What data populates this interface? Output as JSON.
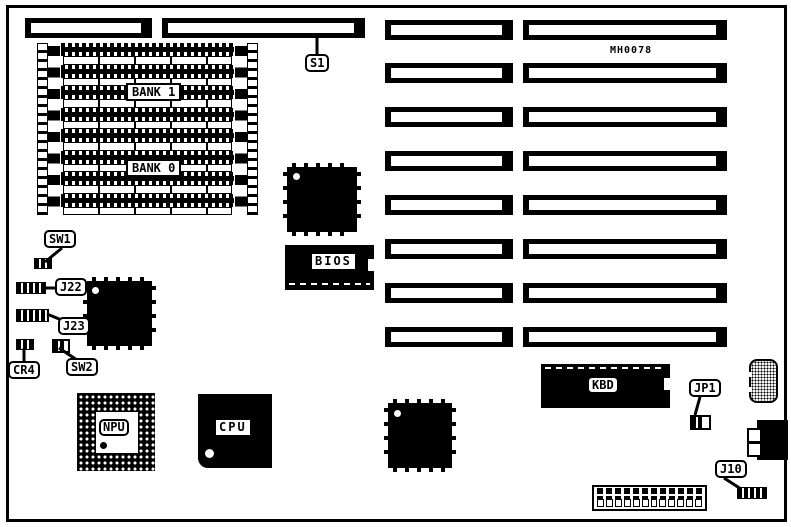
{
  "figure": {
    "part_number": "MH0078"
  },
  "labels": {
    "s1": "S1",
    "bank1": "BANK 1",
    "bank0": "BANK 0",
    "sw1": "SW1",
    "j22": "J22",
    "j23": "J23",
    "cr4": "CR4",
    "sw2": "SW2",
    "bios": "BIOS",
    "npu": "NPU",
    "cpu": "CPU",
    "kbd": "KBD",
    "jp1": "JP1",
    "j10": "J10"
  },
  "colors": {
    "ink": "#000000",
    "paper": "#ffffff"
  },
  "layout_counts": {
    "memory_dip_rows": 8,
    "expansion_slot_rows": 8,
    "power_connector_pins": 12
  }
}
